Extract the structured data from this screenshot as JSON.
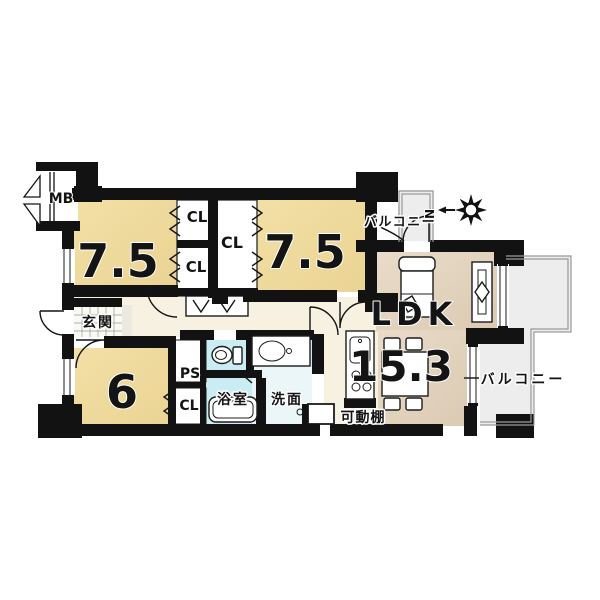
{
  "document": {
    "type": "japanese-apartment-floor-plan"
  },
  "labels": {
    "meter_box": "MB",
    "bedroom1_size": "7.5",
    "bedroom2_size": "7.5",
    "bedroom3_size": "6",
    "ldk_name": "LDK",
    "ldk_size": "15.3",
    "closet": "CL",
    "pipe_space": "PS",
    "entrance": "玄関",
    "bathroom": "浴室",
    "washroom": "洗面",
    "movable_shelf": "可動棚",
    "balcony_top": "バルコニー",
    "balcony_right": "バルコニー"
  },
  "compass": {
    "north": "N"
  },
  "colors": {
    "wall": "#121212",
    "bedroom_fill": "#f3e0a6",
    "bedroom_fill_dark": "#ead393",
    "ldk_fill": "#e9dcc9",
    "ldk_fill_dark": "#dbcab2",
    "wet_fill": "#c9edf2",
    "wet_fill_light": "#eaf6f7",
    "balcony_fill": "#ededed",
    "hallway_fill": "#f7f1e2",
    "tile_fill": "#fafaf4"
  }
}
